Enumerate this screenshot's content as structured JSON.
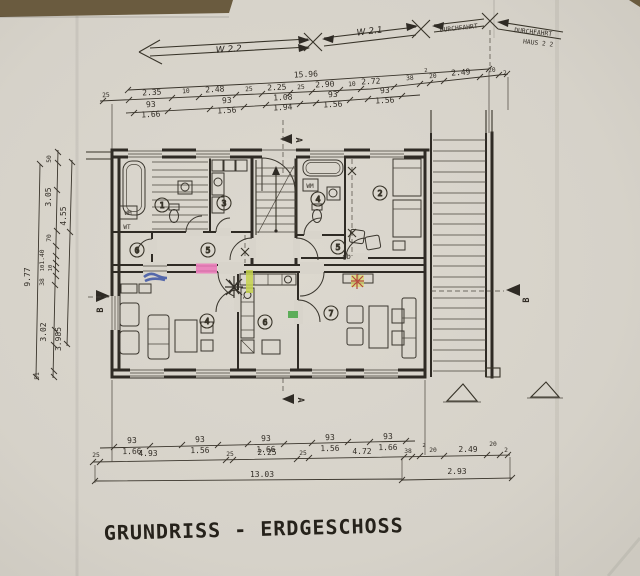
{
  "title": "GRUNDRISS - ERDGESCHOSS",
  "top_annotations": {
    "wing_left": "W 2.2",
    "wing_right": "W 2.1",
    "passage": "DURCHFAHRT",
    "passage2": "DURCHFAHRT",
    "house": "HAUS 2 2"
  },
  "dims_top": {
    "overall": "15.96",
    "row2": [
      "25",
      "2.35",
      "10",
      "2.48",
      "25",
      "2.25",
      "25",
      "2.90",
      "10",
      "2.72",
      "38",
      "2",
      "20",
      "2.49",
      "20",
      "2"
    ],
    "windows": [
      [
        "93",
        "1.66"
      ],
      [
        "93",
        "1.56"
      ],
      [
        "1.08",
        "1.94"
      ],
      [
        "93",
        "1.56"
      ],
      [
        "93",
        "1.56"
      ]
    ]
  },
  "dims_bottom": {
    "windows": [
      [
        "93",
        "1.66"
      ],
      [
        "93",
        "1.56"
      ],
      [
        "93",
        "1.66"
      ],
      [
        "93",
        "1.56"
      ],
      [
        "93",
        "1.66"
      ]
    ],
    "row2": [
      "25",
      "4.93",
      "25",
      "2.25",
      "25",
      "4.72",
      "38",
      "2",
      "20",
      "2.49",
      "20",
      "2"
    ],
    "row3": [
      "13.03",
      "2.93"
    ]
  },
  "dims_left": {
    "overall": "9.77",
    "chain": [
      "50",
      "3.05",
      "4.55",
      "70",
      "1.40",
      "10",
      "10",
      "38",
      "3.02",
      "3.985",
      "51"
    ]
  },
  "rooms": {
    "left": [
      "1",
      "3",
      "5",
      "6",
      "4"
    ],
    "right": [
      "4",
      "2",
      "5",
      "6",
      "7"
    ]
  },
  "labels": {
    "wm": "WM",
    "wt": "WT",
    "handwritten_blue": "Gb"
  },
  "sections": {
    "a": "A",
    "b": "B"
  },
  "colors": {
    "pink": "#ee6fb9",
    "blue": "#3c55a4",
    "yellow_green": "#c5d34c",
    "green": "#3da23c",
    "red": "#b5473e",
    "ink": "#2f2b25",
    "paper": "#d8d4cb"
  }
}
